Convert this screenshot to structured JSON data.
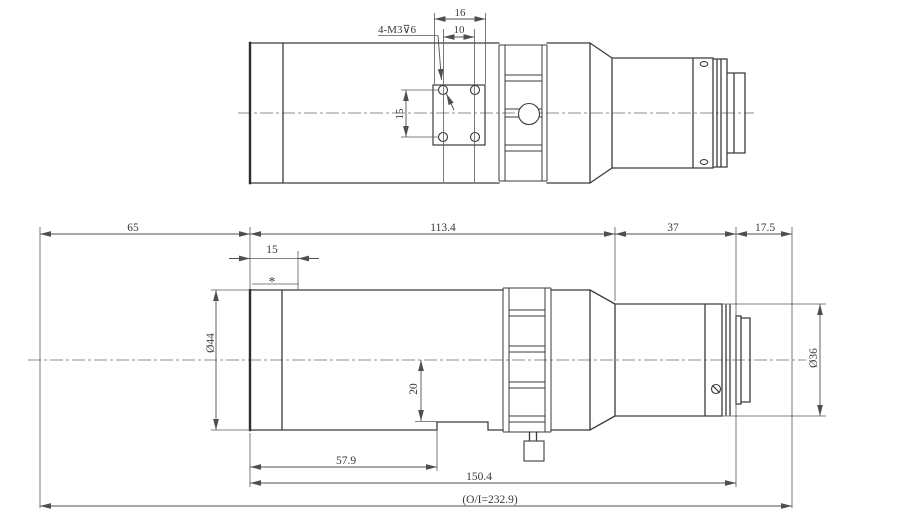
{
  "top_view": {
    "thread_callout": "4-M3⊽6",
    "dim_plate_width": "16",
    "dim_hole_spacing_h": "10",
    "dim_hole_spacing_v": "15"
  },
  "side_view": {
    "dim_object_to_front": "65",
    "dim_front_section_length": "113.4",
    "dim_rear_section": "37",
    "dim_flange_to_image": "17.5",
    "dim_front_ring": "15",
    "front_ring_note": "*",
    "dim_front_diameter": "Ø44",
    "dim_rear_diameter": "Ø36",
    "dim_axis_to_flat": "20",
    "dim_front_to_slot": "57.9",
    "dim_front_to_flange": "150.4",
    "dim_total_track": "(O/I=232.9)"
  }
}
